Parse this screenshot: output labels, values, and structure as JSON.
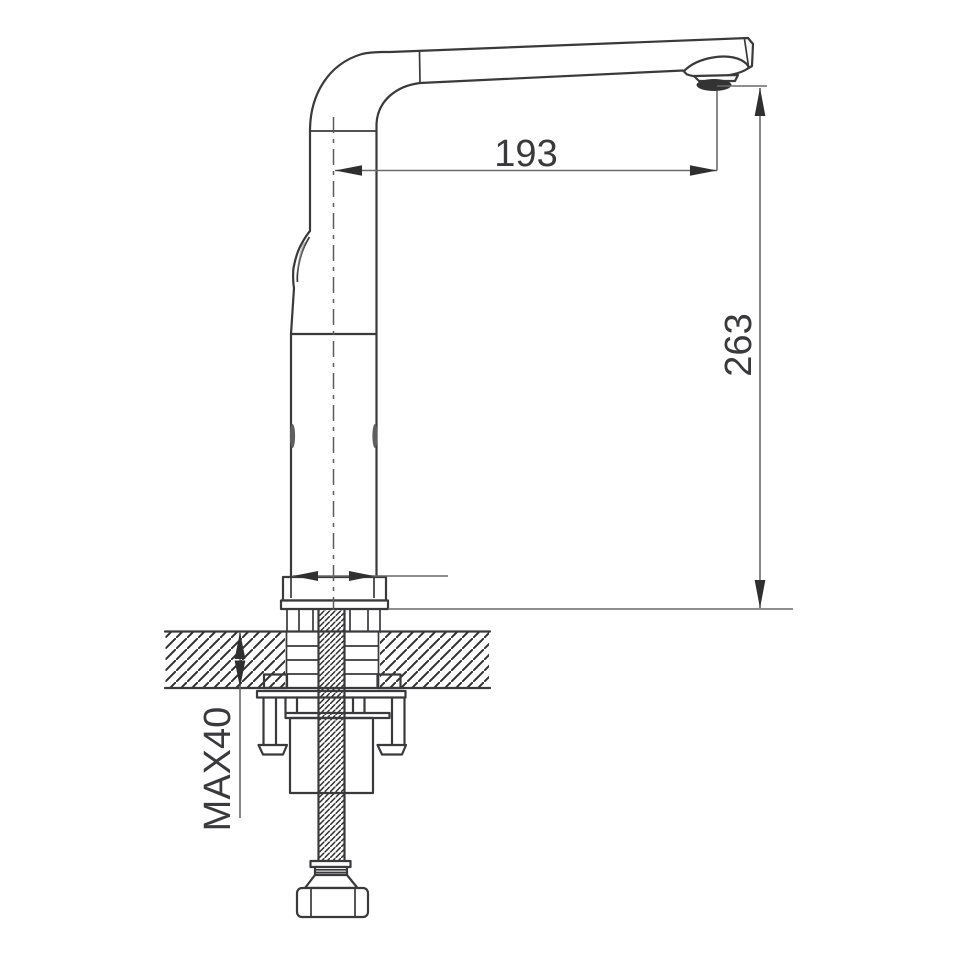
{
  "drawing": {
    "labels": {
      "spout_reach": "193",
      "height": "263",
      "max_thickness": "MAX40"
    },
    "colors": {
      "outline": "#3a3a3c",
      "dimension_line": "#6a6a6a",
      "arrow": "#2f2f2f",
      "text": "#3a3a3c",
      "background": "#ffffff"
    }
  }
}
